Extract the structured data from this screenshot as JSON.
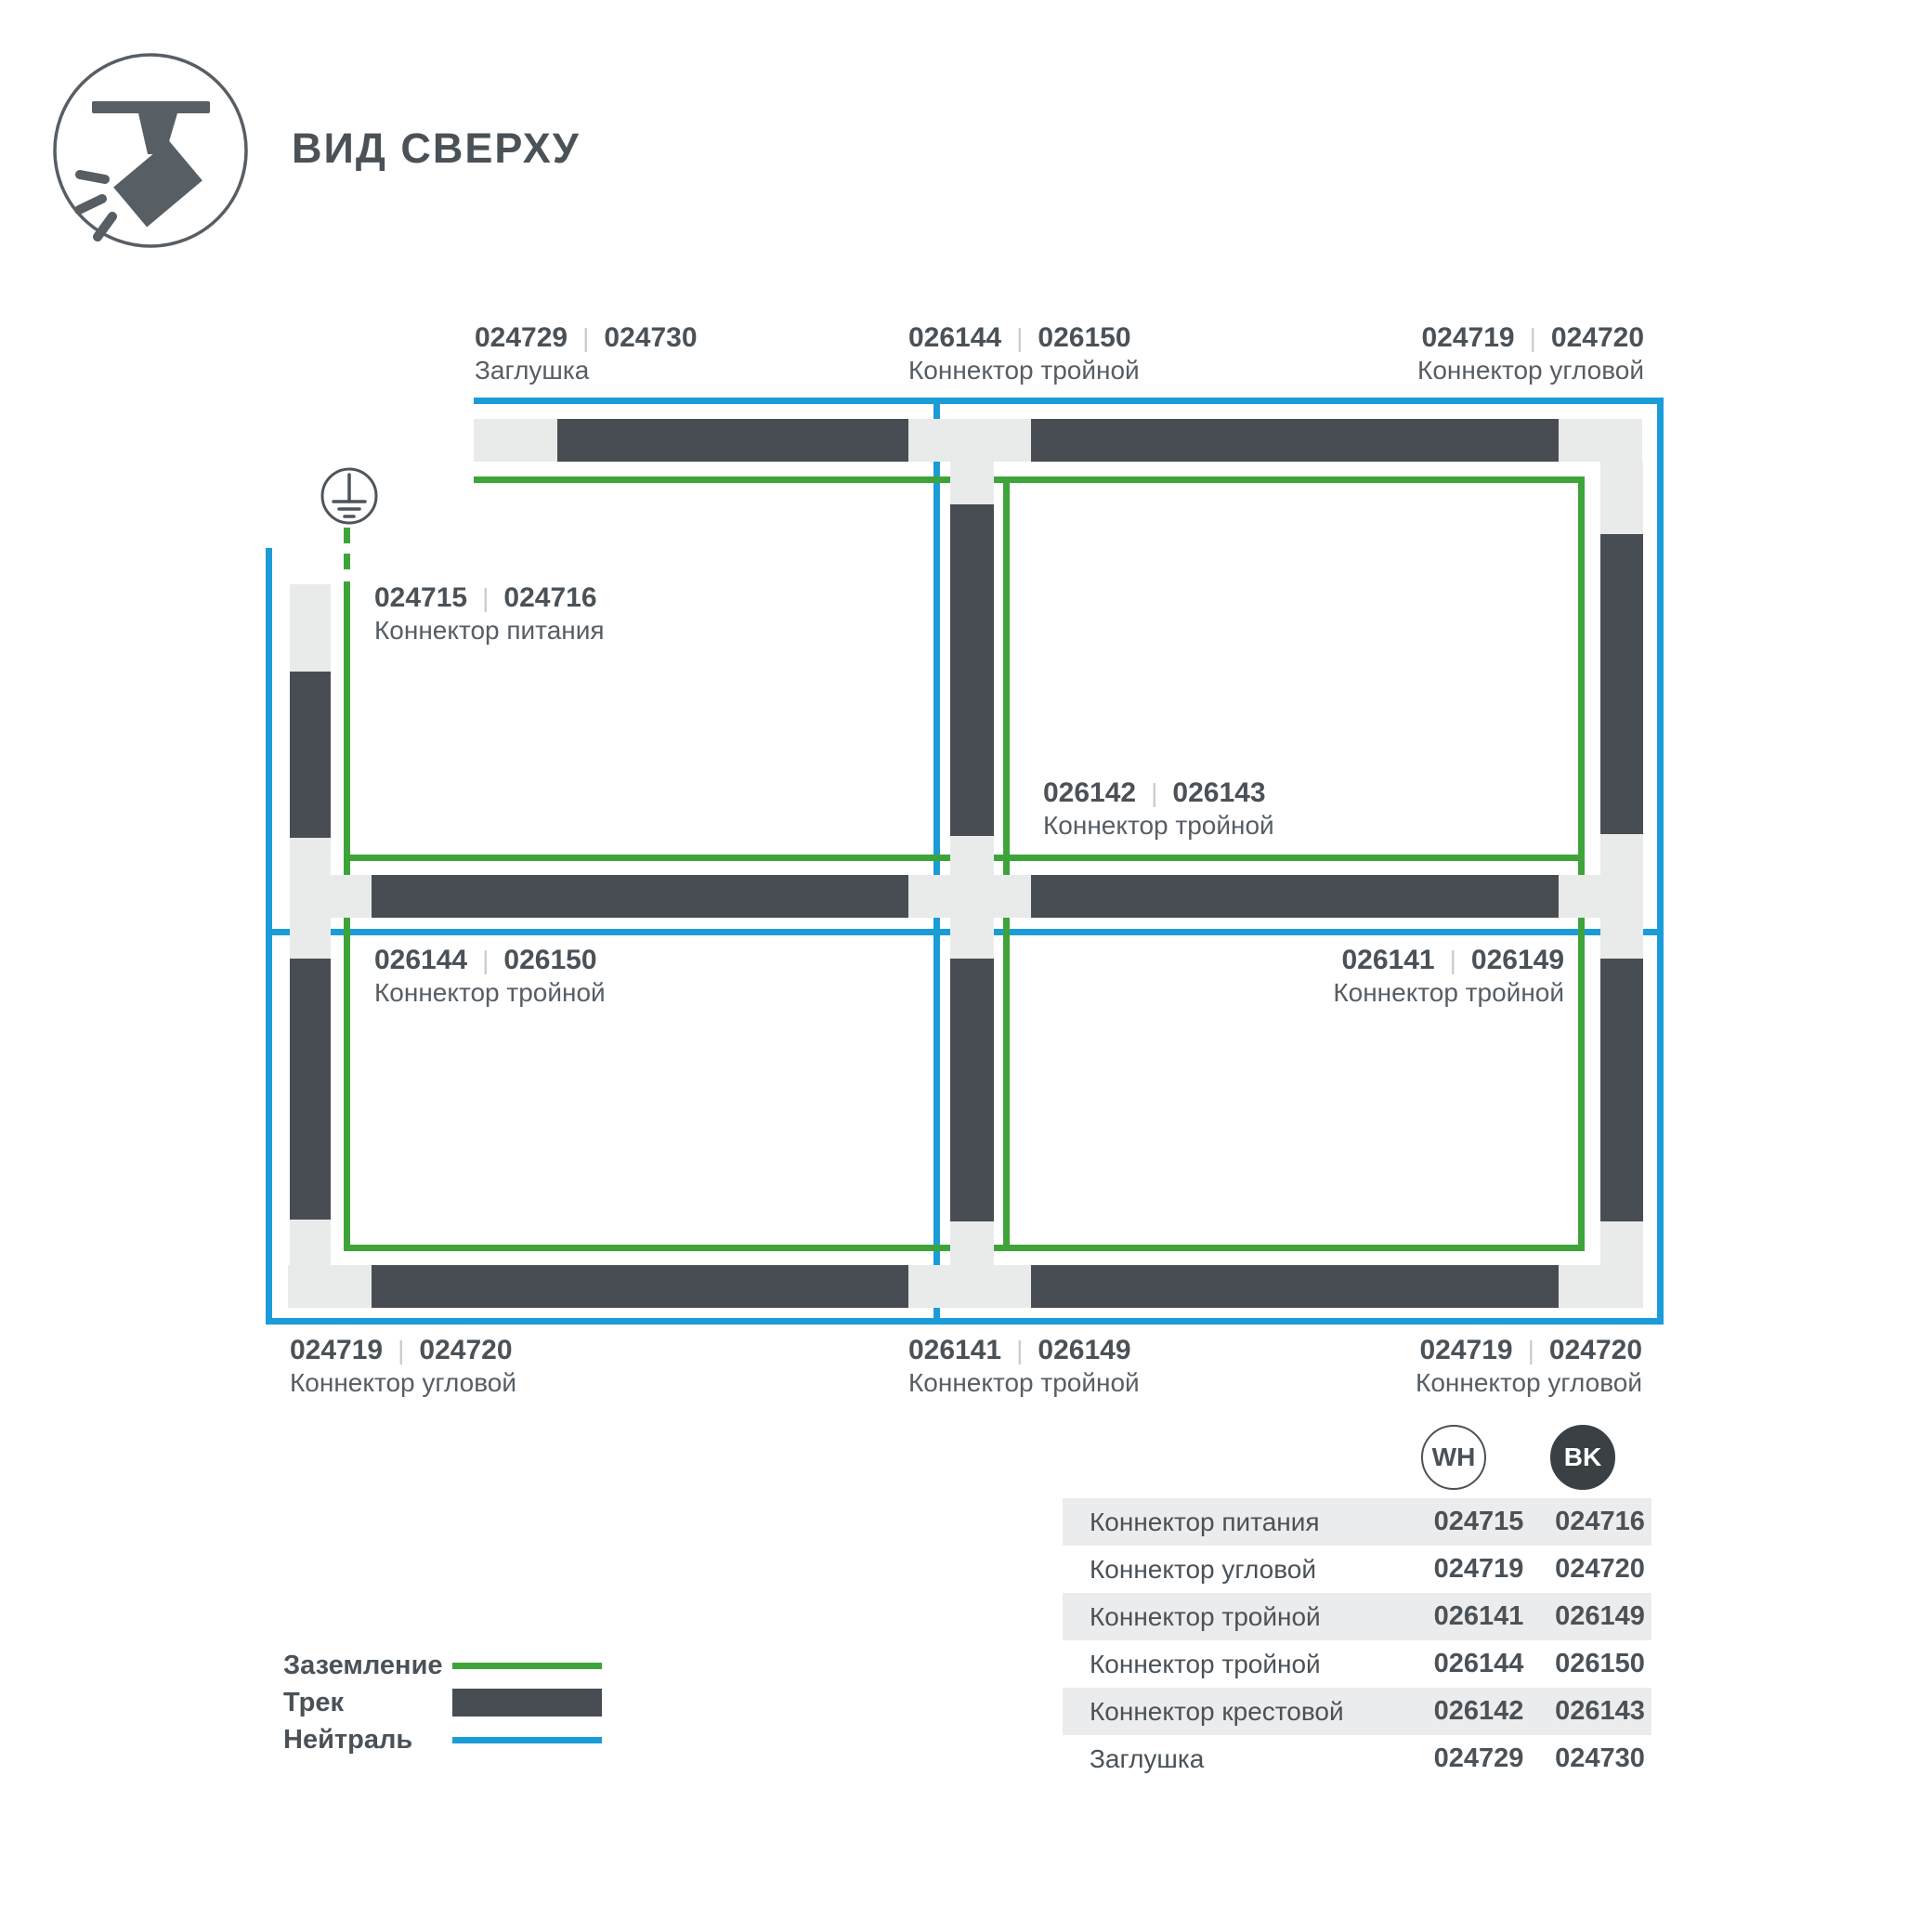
{
  "title": "ВИД СВЕРХУ",
  "ui": {
    "separator": "|"
  },
  "colors": {
    "track": "#474d52",
    "conn": "#e9ebeb",
    "green": "#3ea43a",
    "blue": "#1b9cd7",
    "text": "#4a5258",
    "textsoft": "#565e65",
    "sep": "#c7cccf",
    "rowbg": "#ebeced",
    "bk": "#3a4044"
  },
  "labels": [
    {
      "code_wh": "024729",
      "code_bk": "024730",
      "name": "Заглушка"
    },
    {
      "code_wh": "026144",
      "code_bk": "026150",
      "name": "Коннектор тройной"
    },
    {
      "code_wh": "024719",
      "code_bk": "024720",
      "name": "Коннектор угловой"
    },
    {
      "code_wh": "024715",
      "code_bk": "024716",
      "name": "Коннектор питания"
    },
    {
      "code_wh": "026142",
      "code_bk": "026143",
      "name": "Коннектор тройной"
    },
    {
      "code_wh": "026144",
      "code_bk": "026150",
      "name": "Коннектор тройной"
    },
    {
      "code_wh": "026141",
      "code_bk": "026149",
      "name": "Коннектор тройной"
    },
    {
      "code_wh": "024719",
      "code_bk": "024720",
      "name": "Коннектор угловой"
    },
    {
      "code_wh": "026141",
      "code_bk": "026149",
      "name": "Коннектор тройной"
    },
    {
      "code_wh": "024719",
      "code_bk": "024720",
      "name": "Коннектор угловой"
    }
  ],
  "legend": [
    {
      "label": "Заземление",
      "swatch": "ground-line"
    },
    {
      "label": "Трек",
      "swatch": "track-bar"
    },
    {
      "label": "Нейтраль",
      "swatch": "neutral-line"
    }
  ],
  "table": {
    "columns": [
      "WH",
      "BK"
    ],
    "rows": [
      {
        "name": "Коннектор питания",
        "wh": "024715",
        "bk": "024716"
      },
      {
        "name": "Коннектор угловой",
        "wh": "024719",
        "bk": "024720"
      },
      {
        "name": "Коннектор тройной",
        "wh": "026141",
        "bk": "026149"
      },
      {
        "name": "Коннектор тройной",
        "wh": "026144",
        "bk": "026150"
      },
      {
        "name": "Коннектор крестовой",
        "wh": "026142",
        "bk": "026143"
      },
      {
        "name": "Заглушка",
        "wh": "024729",
        "bk": "024730"
      }
    ]
  }
}
